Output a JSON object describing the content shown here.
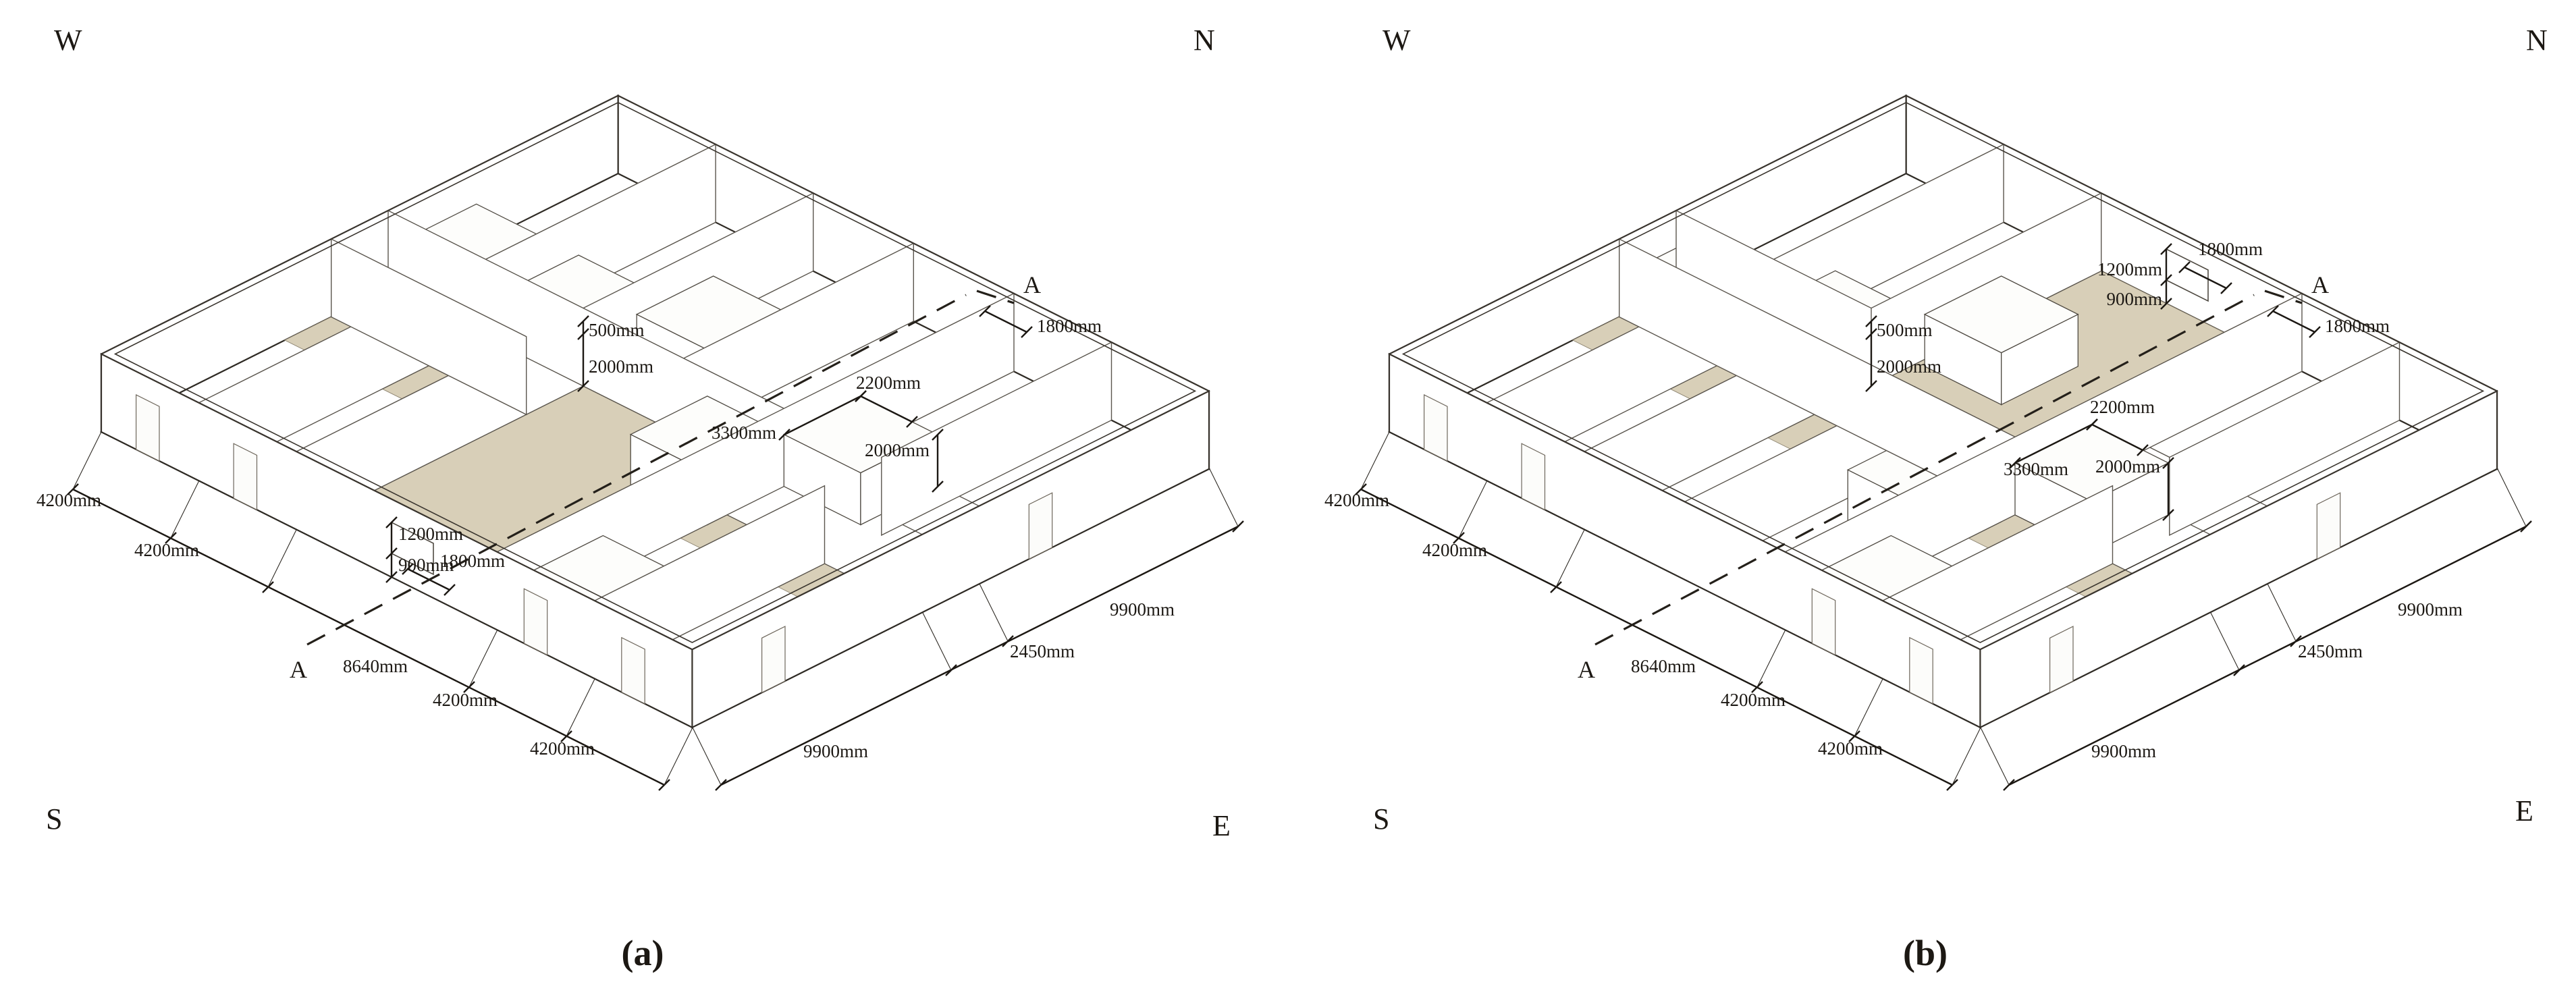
{
  "figure": {
    "type": "axonometric-floor-plan-comparison",
    "floor_highlight_color": "#d8cfb8",
    "panels": [
      {
        "caption": "(a)",
        "compass": {
          "w": "W",
          "n": "N",
          "s": "S",
          "e": "E"
        },
        "section_marker": "A",
        "dims": {
          "gap500": "500mm",
          "hall_height": "2000mm",
          "ne_opening": "1800mm",
          "door_height": "2000mm",
          "box_width": "2200mm",
          "box_length": "3300mm",
          "window_width": "1800mm",
          "window_height": "1200mm",
          "window_sill": "900mm",
          "bay1": "4200mm",
          "bay2": "4200mm",
          "hall_span": "8640mm",
          "bay3": "4200mm",
          "bay4": "4200mm",
          "depth1": "9900mm",
          "corridor": "2450mm",
          "depth2": "9900mm"
        }
      },
      {
        "caption": "(b)",
        "compass": {
          "w": "W",
          "n": "N",
          "s": "S",
          "e": "E"
        },
        "section_marker": "A",
        "dims": {
          "gap500": "500mm",
          "hall_height": "2000mm",
          "ne_opening": "1800mm",
          "door_height": "2000mm",
          "box_width": "2200mm",
          "box_length": "3300mm",
          "window_width": "1800mm",
          "window_height": "1200mm",
          "window_sill": "900mm",
          "bay1": "4200mm",
          "bay2": "4200mm",
          "hall_span": "8640mm",
          "bay3": "4200mm",
          "bay4": "4200mm",
          "depth1": "9900mm",
          "corridor": "2450mm",
          "depth2": "9900mm"
        }
      }
    ]
  }
}
